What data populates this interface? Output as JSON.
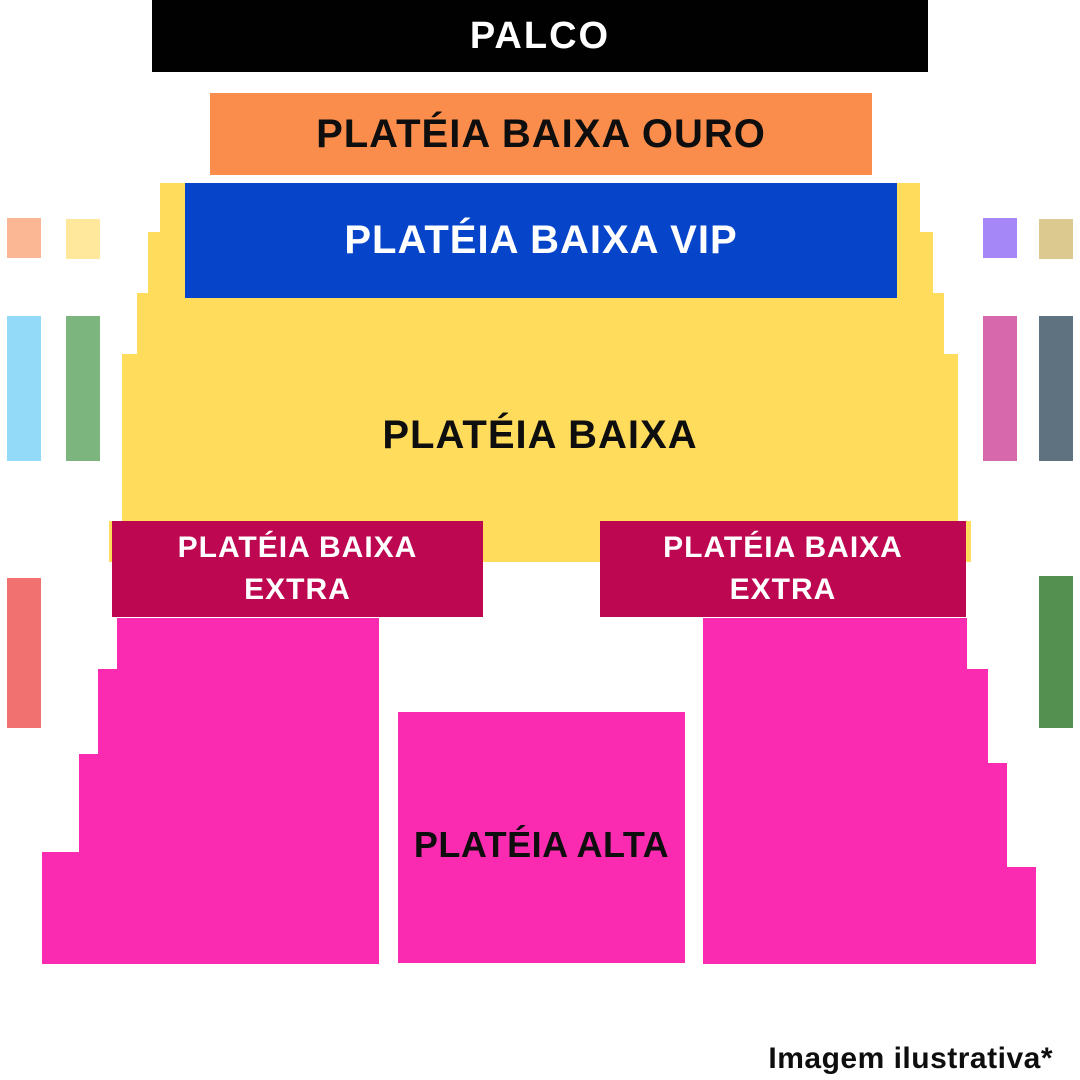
{
  "stage": {
    "label": "PALCO",
    "bg": "#010101",
    "fg": "#FFFFFF"
  },
  "sections": {
    "ouro": {
      "label": "PLATÉIA BAIXA OURO",
      "bg": "#FB8D4C",
      "fg": "#0E0E0E"
    },
    "vip": {
      "label": "PLATÉIA BAIXA VIP",
      "bg": "#0645C9",
      "fg": "#FFFFFF"
    },
    "baixa": {
      "label": "PLATÉIA BAIXA",
      "bg": "#FFDC5C",
      "fg": "#0E0E0E"
    },
    "extra_left": {
      "line1": "PLATÉIA BAIXA",
      "line2": "EXTRA",
      "bg": "#BE0751",
      "fg": "#FFFFFF"
    },
    "extra_right": {
      "line1": "PLATÉIA BAIXA",
      "line2": "EXTRA",
      "bg": "#BE0751",
      "fg": "#FFFFFF"
    },
    "alta": {
      "label": "PLATÉIA ALTA",
      "bg": "#FA2BB1",
      "fg": "#0E0E0E"
    }
  },
  "side_boxes": [
    {
      "id": "box-upper-left-outer",
      "bg": "#FBB694"
    },
    {
      "id": "box-upper-left-inner",
      "bg": "#FFE79C"
    },
    {
      "id": "box-middle-left-outer",
      "bg": "#93D9F8"
    },
    {
      "id": "box-middle-left-inner",
      "bg": "#7CB57E"
    },
    {
      "id": "box-lower-left-outer",
      "bg": "#F17070"
    },
    {
      "id": "box-upper-right-inner",
      "bg": "#A687F8"
    },
    {
      "id": "box-upper-right-outer",
      "bg": "#DBC98F"
    },
    {
      "id": "box-middle-right-inner",
      "bg": "#D868AC"
    },
    {
      "id": "box-middle-right-outer",
      "bg": "#5E7280"
    },
    {
      "id": "box-lower-right-outer",
      "bg": "#549151"
    }
  ],
  "footnote": {
    "text": "Imagem ilustrativa*",
    "fg": "#0E0E0E"
  }
}
